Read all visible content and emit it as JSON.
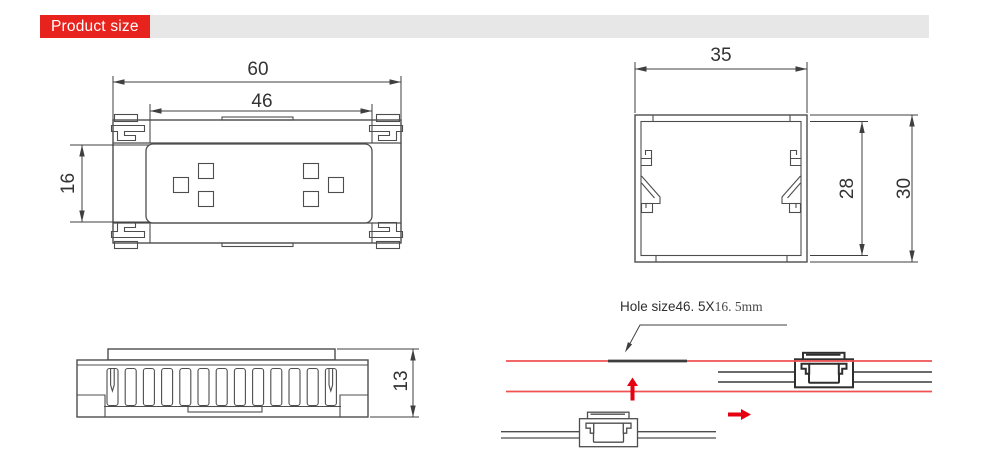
{
  "header": {
    "title": "Product size"
  },
  "views": {
    "front": {
      "dims": {
        "outer_width": "60",
        "inner_width": "46",
        "inner_height": "16"
      }
    },
    "section": {
      "dims": {
        "width": "35",
        "inner_height": "28",
        "outer_height": "30"
      }
    },
    "profile": {
      "dims": {
        "height": "13"
      }
    },
    "installation": {
      "hole_label": {
        "prefix": "Hole size46. 5X",
        "suffix": "16. 5mm"
      }
    }
  },
  "colors": {
    "accent_red": "#e8231d",
    "header_bar_bg": "#e7e7e7",
    "panel_red": "#ef5050",
    "arrow_red": "#e60012",
    "hole_dark": "#3d3d3d",
    "line_dark": "#4d4d4d",
    "dim_line": "#3f3f3f",
    "dim_text": "#333333"
  }
}
